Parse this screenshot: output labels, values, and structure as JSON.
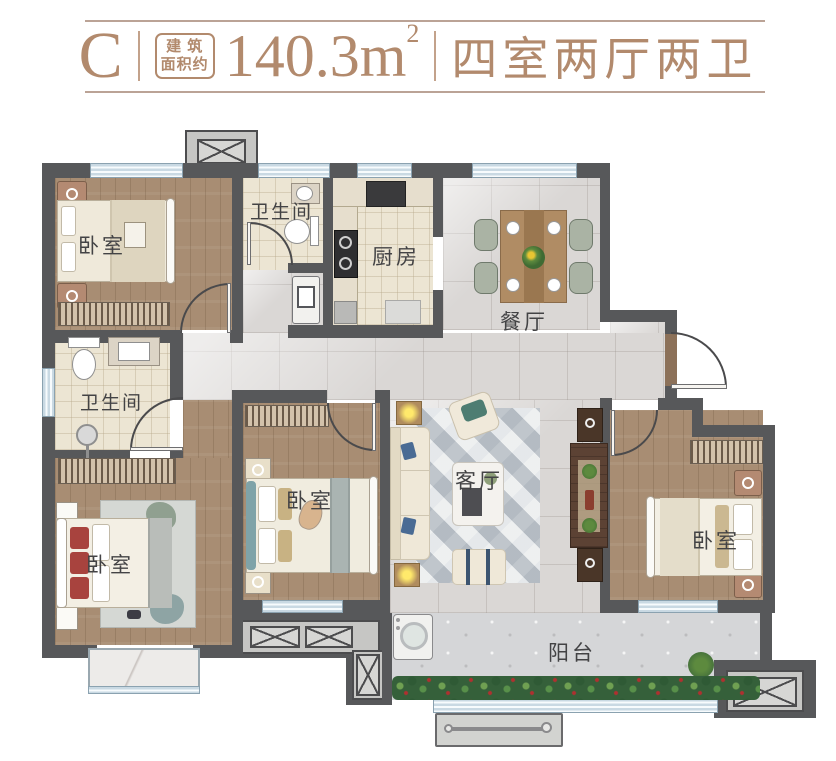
{
  "header": {
    "unit": "C",
    "stamp_top": "建 筑",
    "stamp_bottom": "面积约",
    "area": "140.3m",
    "area_sup": "2",
    "spec": "四室两厅两卫",
    "accent_color": "#b28a6d"
  },
  "floorplan": {
    "rooms": [
      {
        "id": "bedroom-top-left",
        "label": "卧室"
      },
      {
        "id": "bathroom-top",
        "label": "卫生间"
      },
      {
        "id": "kitchen",
        "label": "厨房"
      },
      {
        "id": "dining-room",
        "label": "餐厅"
      },
      {
        "id": "bathroom-left",
        "label": "卫生间"
      },
      {
        "id": "bedroom-bottom-left",
        "label": "卧室"
      },
      {
        "id": "bedroom-middle",
        "label": "卧室"
      },
      {
        "id": "living-room",
        "label": "客厅"
      },
      {
        "id": "bedroom-right",
        "label": "卧室"
      },
      {
        "id": "balcony",
        "label": "阳台"
      }
    ],
    "colors": {
      "wall": "#57585a",
      "wood_floor": "#a88d73",
      "tile_floor": "#ece5d3",
      "marble_floor": "#dad7d5",
      "window": "#c9d9e3",
      "label_text": "#434345"
    }
  }
}
